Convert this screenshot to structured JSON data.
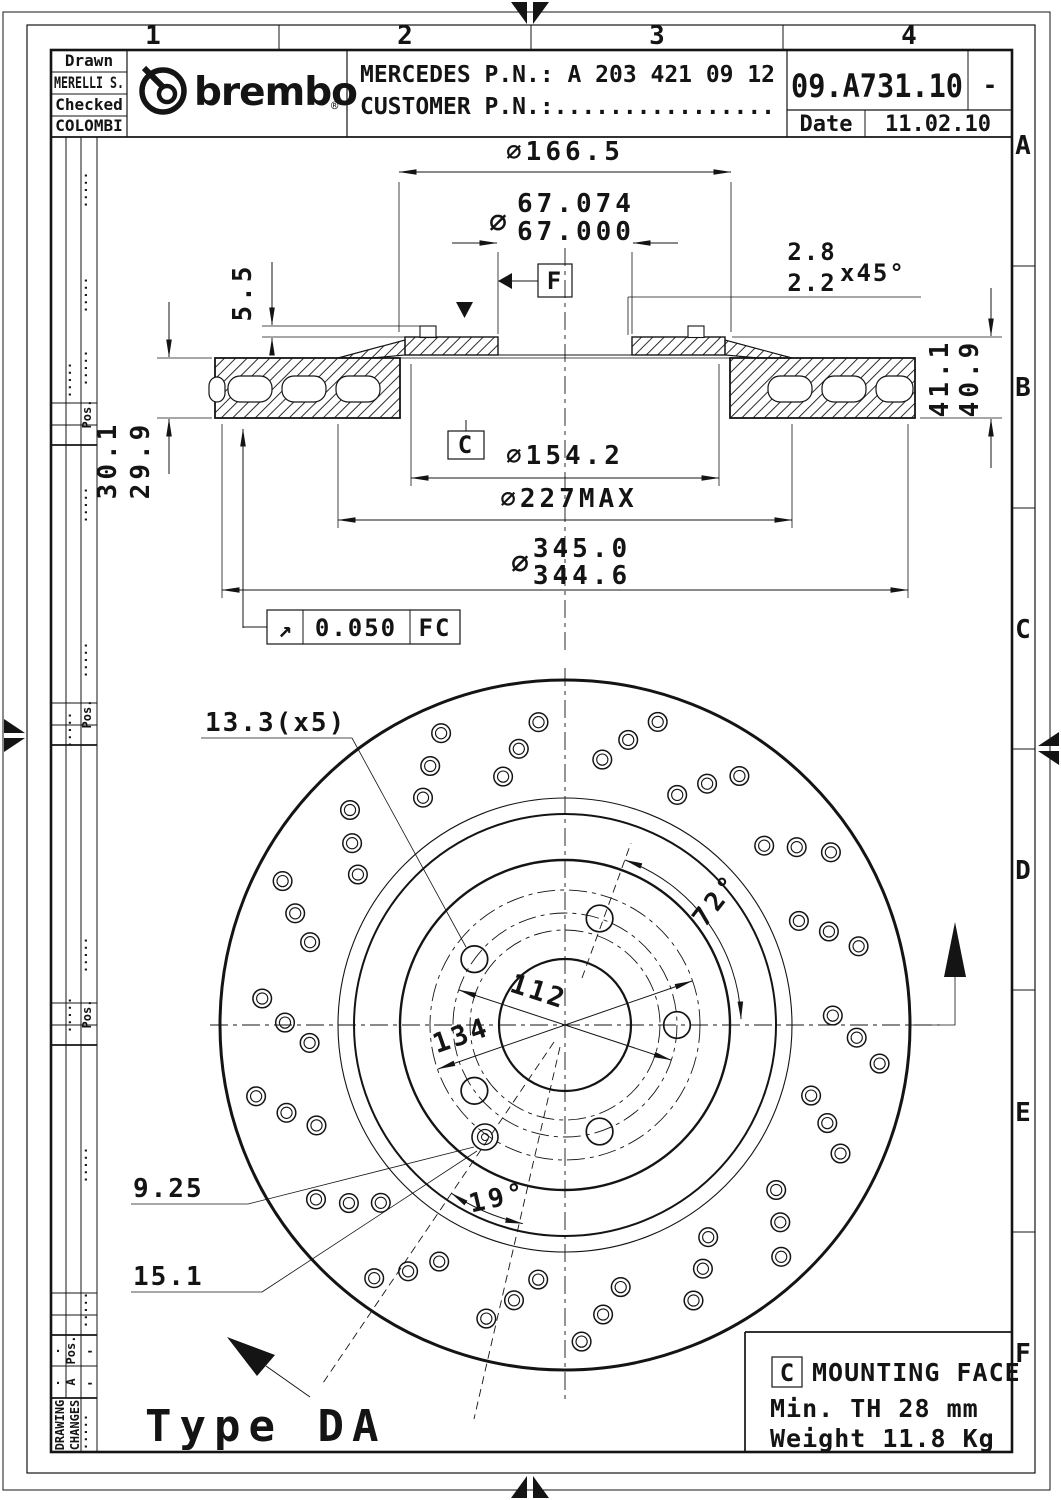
{
  "title_block": {
    "drawn_label": "Drawn",
    "drawn_name": "MERELLI S.",
    "checked_label": "Checked",
    "checked_name": "COLOMBI",
    "brand": "brembo",
    "registered": "®",
    "mercedes_pn": "MERCEDES P.N.: A 203 421 09 12",
    "customer_pn": "CUSTOMER P.N.:................",
    "part_number": "09.A731.10",
    "revision": "-",
    "date_label": "Date",
    "date_value": "11.02.10"
  },
  "grid": {
    "columns": [
      "1",
      "2",
      "3",
      "4"
    ],
    "rows": [
      "A",
      "B",
      "C",
      "D",
      "E",
      "F"
    ]
  },
  "revision_strip": {
    "drawing": "DRAWING",
    "changes": "CHANGES",
    "pos": "Pos.",
    "revision": "A",
    "dash": "-",
    "dots": "·····",
    "dot": "·"
  },
  "section_view": {
    "dia_flange": "∅166.5",
    "dia_symbol": "∅",
    "bore_max": "67.074",
    "bore_min": "67.000",
    "chamfer_max": "2.8",
    "chamfer_min": "2.2",
    "chamfer_angle": "x45°",
    "flange_thickness": "5.5",
    "overall_max": "41.1",
    "overall_min": "40.9",
    "band_max": "30.1",
    "band_min": "29.9",
    "dia_hat": "∅154.2",
    "dia_inner": "∅227MAX",
    "od_max": "345.0",
    "od_min": "344.6",
    "runout_symbol": "↗",
    "runout_value": "0.050",
    "runout_ref": "FC",
    "datum_f": "F",
    "datum_c": "C"
  },
  "front_view": {
    "hole_dia": "13.3(x5)",
    "bolt_angle": "72°",
    "pcd": "112",
    "pilot_dia": "134",
    "pin_angle": "19°",
    "pin_a": "9.25",
    "pin_b": "15.1",
    "type_label": "Type DA"
  },
  "note": {
    "datum": "C",
    "title": "MOUNTING FACE",
    "min_thickness": "Min. TH 28 mm",
    "weight": "Weight 11.8 Kg"
  }
}
